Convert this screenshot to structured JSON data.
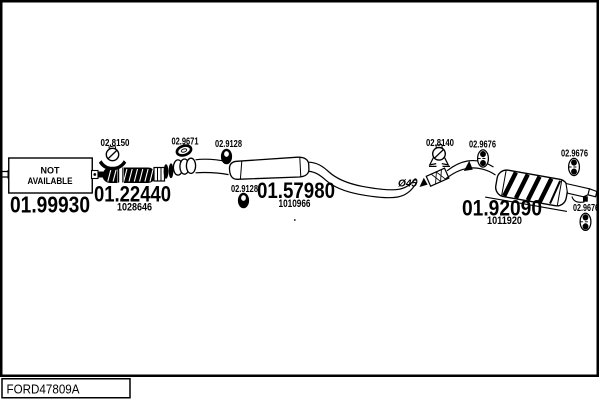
{
  "colors": {
    "ink": "#000000",
    "paper": "#ffffff"
  },
  "footer": {
    "vehicle_code": "FORD47809A"
  },
  "not_available": {
    "line1": "NOT",
    "line2": "AVAILABLE"
  },
  "annotations": {
    "pipe_diameter": "Ø45"
  },
  "parts": {
    "front_pipe": {
      "number": "01.99930"
    },
    "flex_pipe": {
      "number": "01.22440",
      "oe_ref": "1028646"
    },
    "centre_silencer": {
      "number": "01.57980",
      "oe_ref": "1010966"
    },
    "rear_silencer": {
      "number": "01.92090",
      "oe_ref": "1011920"
    }
  },
  "fittings": {
    "front_clamp": {
      "number": "02.8150"
    },
    "gasket": {
      "number": "02.9671"
    },
    "centre_hanger_top": {
      "number": "02.9128"
    },
    "centre_hanger_bottom": {
      "number": "02.9128"
    },
    "rear_clamp": {
      "number": "02.8140"
    },
    "rear_hanger_top": {
      "number": "02.9676"
    },
    "rear_hanger_right": {
      "number": "02.9676"
    },
    "rear_hanger_bottom": {
      "number": "02.9676"
    }
  }
}
